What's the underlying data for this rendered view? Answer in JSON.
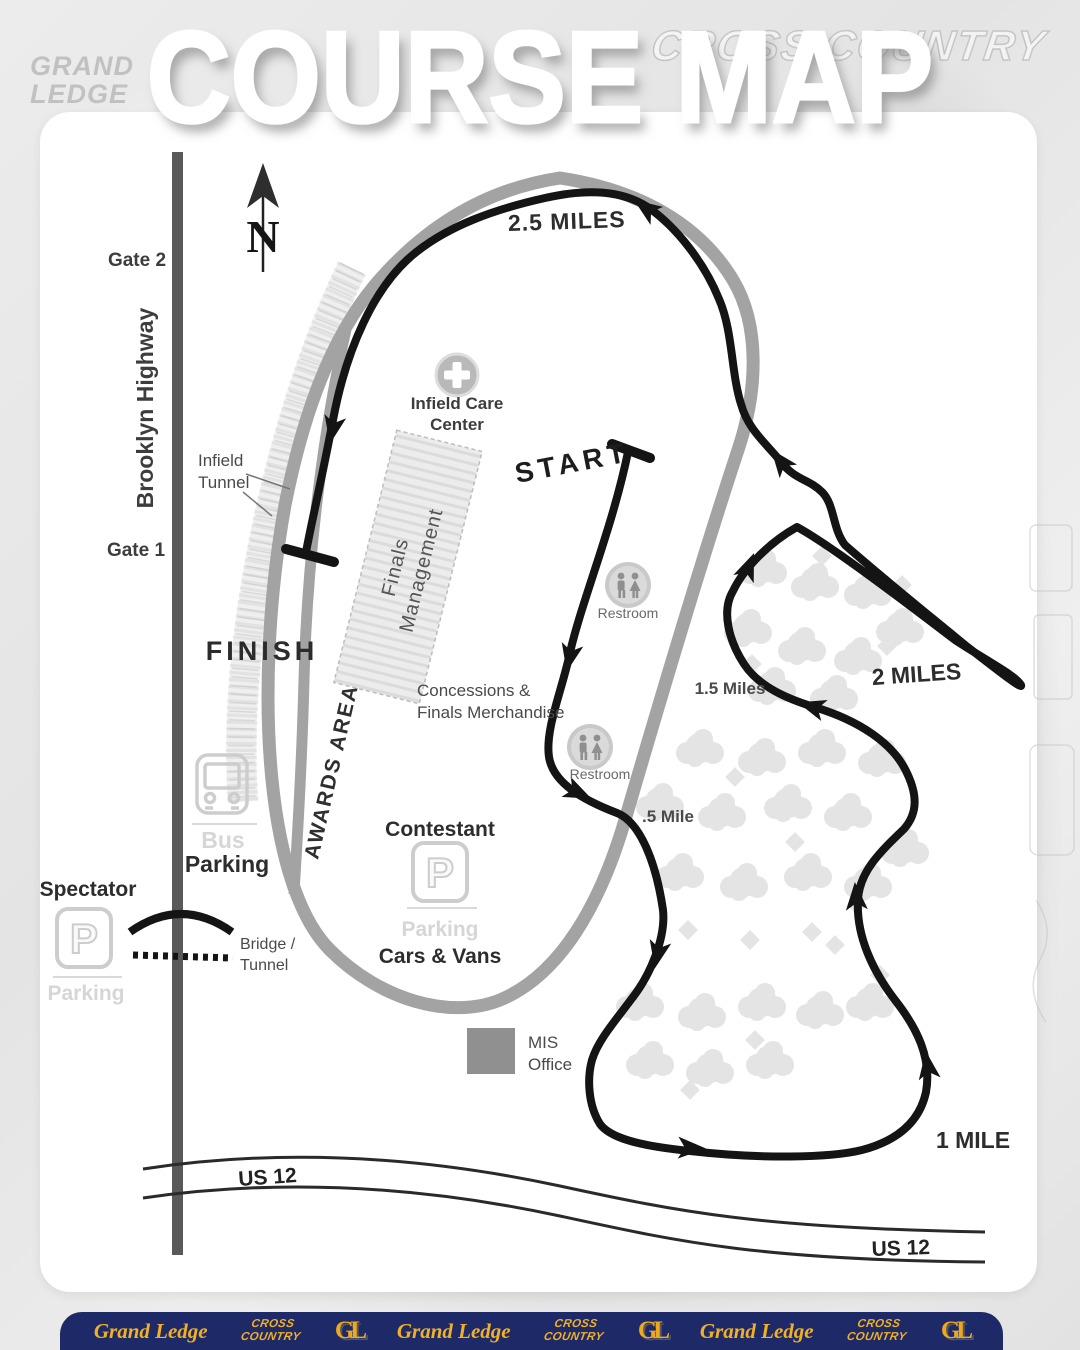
{
  "title": "COURSE MAP",
  "watermarks": {
    "top_right": "CROSS COUNTRY",
    "logo_line1": "GRAND",
    "logo_line2": "LEDGE"
  },
  "compass": {
    "north_label": "N"
  },
  "roads": {
    "brooklyn_highway": "Brooklyn Highway",
    "us12_west": "US 12",
    "us12_east": "US 12"
  },
  "gates": {
    "gate_2": "Gate 2",
    "gate_1": "Gate 1"
  },
  "course": {
    "start_label": "START",
    "finish_label": "FINISH",
    "marker_half_mile": ".5 Mile",
    "marker_1_mile": "1 MILE",
    "marker_1_5_miles": "1.5 Miles",
    "marker_2_miles": "2 MILES",
    "marker_2_5_miles": "2.5 MILES",
    "line_color": "#141414",
    "track_color": "#a3a3a3"
  },
  "facilities": {
    "infield_care_center": {
      "line1": "Infield Care",
      "line2": "Center"
    },
    "infield_tunnel": {
      "line1": "Infield",
      "line2": "Tunnel"
    },
    "finals_management": {
      "line1": "Finals",
      "line2": "Management"
    },
    "concessions": {
      "line1": "Concessions &",
      "line2": "Finals Merchandise"
    },
    "awards_area": "AWARDS AREA",
    "restroom_north": "Restroom",
    "restroom_south": "Restroom",
    "mis_office": {
      "line1": "MIS",
      "line2": "Office"
    },
    "bridge_tunnel": {
      "line1": "Bridge /",
      "line2": "Tunnel"
    }
  },
  "parking": {
    "p_symbol": "P",
    "bus": {
      "line1": "Bus",
      "line2": "Parking"
    },
    "spectator": {
      "title": "Spectator",
      "subtitle": "Parking"
    },
    "contestant": {
      "title": "Contestant",
      "subtitle": "Parking",
      "note": "Cars & Vans"
    }
  },
  "footer": {
    "brand": "Grand Ledge",
    "sport_line1": "CROSS",
    "sport_line2": "COUNTRY",
    "monogram": "GL",
    "background": "#1e2a68",
    "gold": "#f2b024"
  }
}
